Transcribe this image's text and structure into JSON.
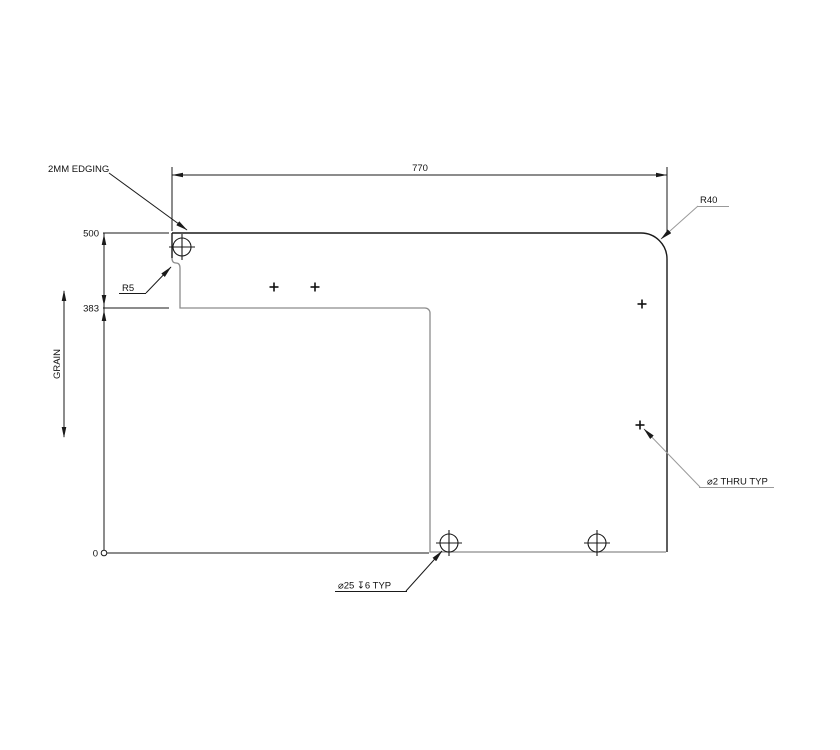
{
  "drawing": {
    "edging_note": "2MM EDGING",
    "dim_width": "770",
    "radius_corner": "R40",
    "radius_notch": "R5",
    "ordinate_top": "500",
    "ordinate_mid": "383",
    "ordinate_zero": "0",
    "grain_label": "GRAIN",
    "thru_hole_note": "⌀2 THRU TYP",
    "cbore_hole_note": "⌀25 ↧6 TYP"
  },
  "colors": {
    "line_dark": "#1a1a1a",
    "edge_gray": "#8c8c8c",
    "leader_gray": "#9a9a9a"
  }
}
